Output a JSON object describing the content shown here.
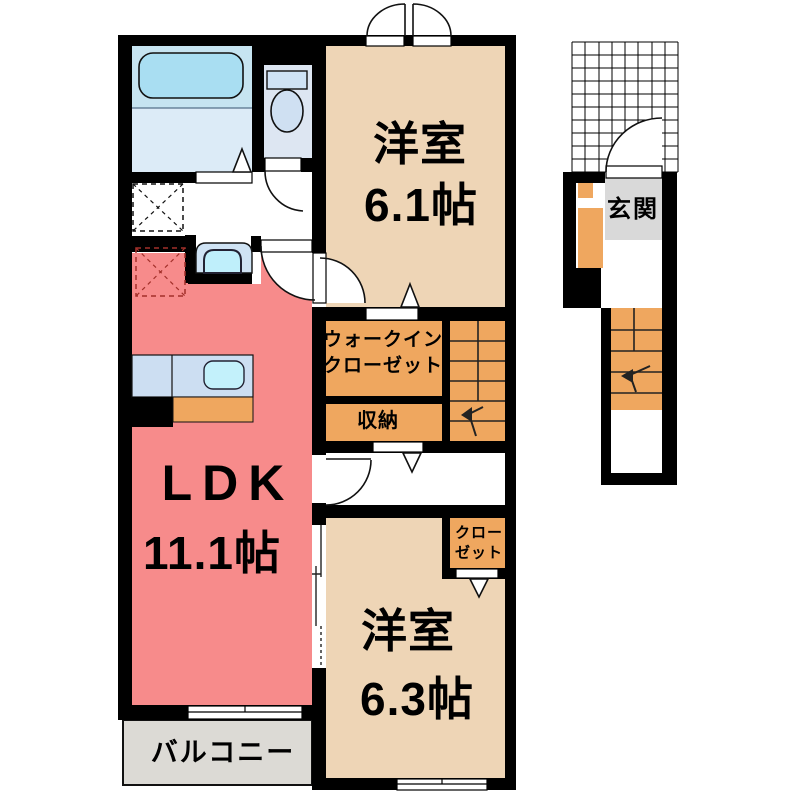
{
  "rooms": {
    "bedroom1": {
      "name": "洋室",
      "size": "6.1帖"
    },
    "bedroom2": {
      "name": "洋室",
      "size": "6.3帖"
    },
    "ldk": {
      "name": "LDK",
      "size": "11.1帖"
    },
    "walk_in_closet": {
      "line1": "ウォークイン",
      "line2": "クローゼット"
    },
    "storage": {
      "name": "収納"
    },
    "closet": {
      "line1": "クロー",
      "line2": "ゼット"
    },
    "balcony": {
      "name": "バルコニー"
    },
    "entrance": {
      "name": "玄関"
    }
  },
  "colors": {
    "wall": "#000000",
    "bedroom_floor": "#eed5b6",
    "ldk_floor": "#f78b8b",
    "storage_floor": "#efa75f",
    "balcony_floor": "#dcdad5",
    "entrance_floor": "#d9d9d9",
    "bathroom_upper": "#c6e4f1",
    "bathroom_lower": "#dcebf7",
    "toilet_room": "#dde6f2",
    "bathtub": "#a9def2",
    "fixture_blue": "#cfe3f4",
    "kitchen_counter": "#ccdef2",
    "sink": "#c3f1fb"
  }
}
